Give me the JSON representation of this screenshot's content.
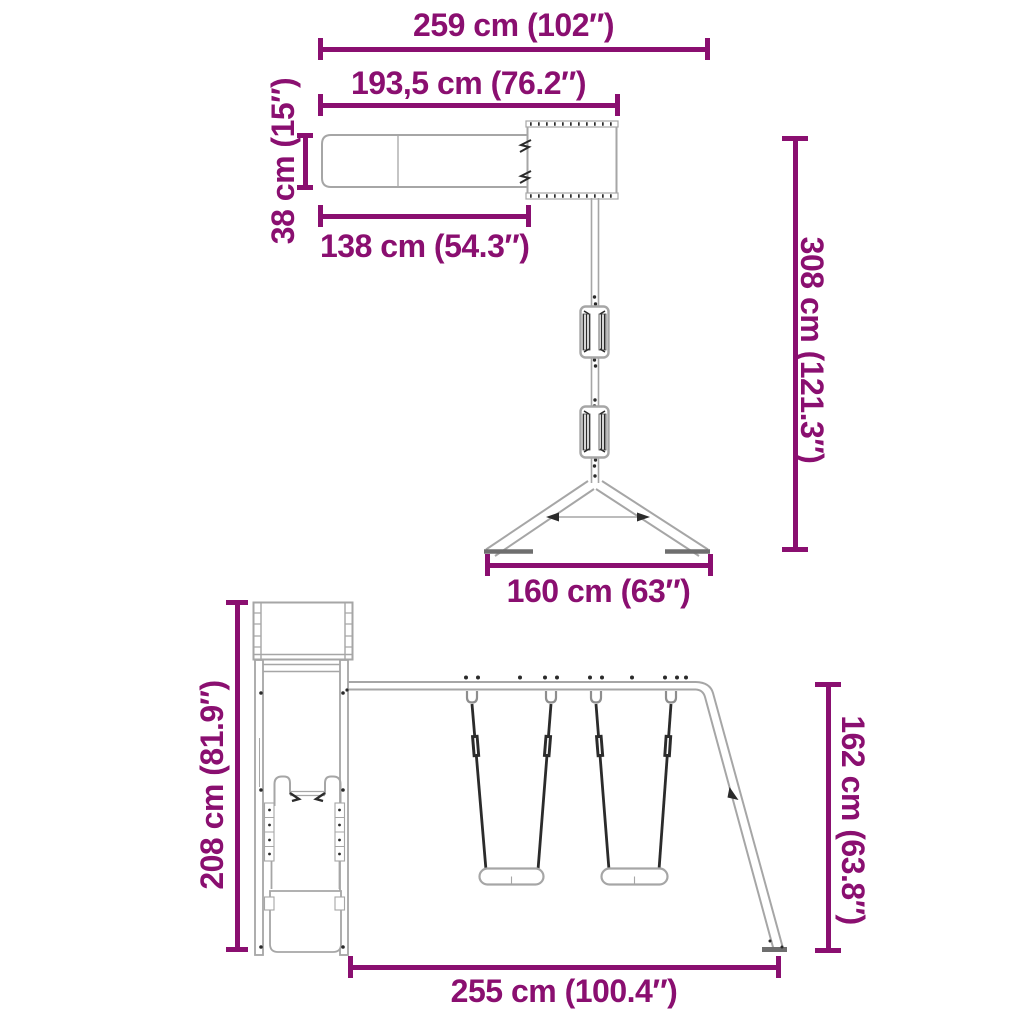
{
  "colors": {
    "dimension": "#8A0F70",
    "structure": "#A6A6A6",
    "detail": "#2B2B2B",
    "background": "#FFFFFF"
  },
  "top_view": {
    "dims": {
      "total_width": "259 cm (102″)",
      "platform_slide_length": "193,5 cm (76.2″)",
      "slide_width": "38 cm (15″)",
      "slide_length": "138 cm (54.3″)",
      "total_height": "308 cm (121.3″)",
      "base_width": "160 cm (63″)"
    }
  },
  "side_view": {
    "dims": {
      "tower_height": "208 cm (81.9″)",
      "swing_frame_height": "162 cm (63.8″)",
      "swing_section_length": "255 cm (100.4″)"
    }
  }
}
